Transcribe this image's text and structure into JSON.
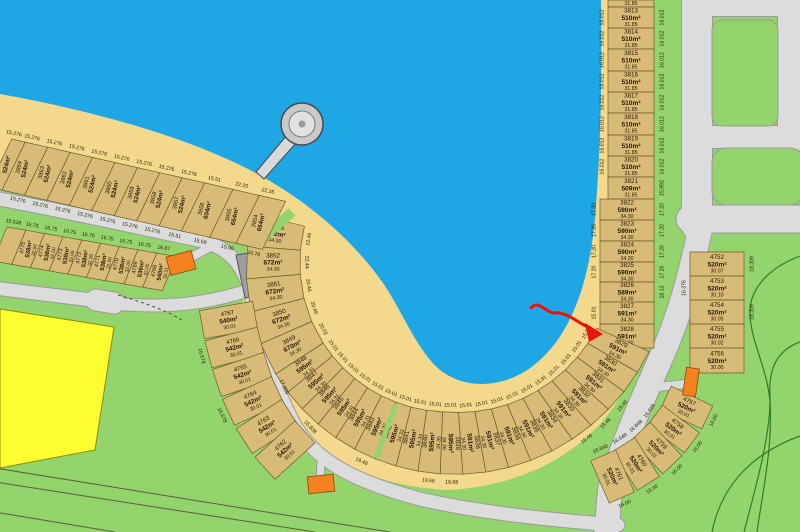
{
  "colors": {
    "water": "#1FA6E4",
    "beach": "#F4D98C",
    "grass": "#94D46C",
    "lot_fill": "#D8BB77",
    "lot_stroke": "#6E5B2B",
    "road_fill": "#DCDCDC",
    "road_stroke": "#9A9A9A",
    "reserve_gray": "#9E9E9E",
    "highlight_yellow": "#FDFD2F",
    "marker_orange": "#F5821F",
    "annotation_red": "#E8150A",
    "contour_green": "#2F7D24",
    "text": "#241A05"
  },
  "annotation": {
    "type": "hand-drawn-arrow",
    "points_to_lot": "3828"
  },
  "features": {
    "pier": "jetty-with-round-head",
    "orange_markers": 3,
    "yellow_parcel": true,
    "gray_reserve_parcel": true
  },
  "lot_groups": {
    "east_column": {
      "lots": [
        {
          "n": "",
          "a": "",
          "d": "31.85"
        },
        {
          "n": "3813",
          "a": "510m²",
          "d": "31.85",
          "in": "16.012",
          "out": "16.012"
        },
        {
          "n": "3814",
          "a": "510m²",
          "d": "31.85",
          "in": "16.012",
          "out": "16.012"
        },
        {
          "n": "3815",
          "a": "510m²",
          "d": "31.85",
          "in": "16.012",
          "out": "16.012"
        },
        {
          "n": "3816",
          "a": "510m²",
          "d": "31.85",
          "in": "16.012",
          "out": "16.012"
        },
        {
          "n": "3817",
          "a": "510m²",
          "d": "31.85",
          "in": "16.012",
          "out": "16.012"
        },
        {
          "n": "3818",
          "a": "510m²",
          "d": "31.85",
          "in": "16.012",
          "out": "16.012"
        },
        {
          "n": "3819",
          "a": "510m²",
          "d": "31.85",
          "in": "16.012",
          "out": "16.012"
        },
        {
          "n": "3820",
          "a": "510m²",
          "d": "31.85",
          "in": "16.012",
          "out": "16.012"
        },
        {
          "n": "3821",
          "a": "509m²",
          "d": "31.85",
          "out": "15.992"
        },
        {
          "n": "3822",
          "a": "590m²",
          "d": "34.30",
          "in": "17.20",
          "out": "17.20"
        },
        {
          "n": "3823",
          "a": "590m²",
          "d": "34.30",
          "in": "17.20",
          "out": "17.20"
        },
        {
          "n": "3824",
          "a": "590m²",
          "d": "34.30",
          "in": "17.20",
          "out": "17.20"
        },
        {
          "n": "3825",
          "a": "590m²",
          "d": "34.30",
          "in": "17.20",
          "out": "17.20"
        },
        {
          "n": "3826",
          "a": "589m²",
          "d": "34.30",
          "out": "18.13"
        },
        {
          "n": "3827",
          "a": "591m²",
          "d": "34.30",
          "in": "15.01"
        },
        {
          "n": "3828",
          "a": "591m²",
          "d": "34.30",
          "in": "15.01"
        }
      ]
    },
    "lake_arc": {
      "lots": [
        {
          "n": "3829",
          "a": "591m²",
          "d": "34.30",
          "in": "15.01"
        },
        {
          "n": "3830",
          "a": "591m²",
          "d": "34.30",
          "in": "15.01"
        },
        {
          "n": "3831",
          "a": "591m²",
          "d": "34.30",
          "in": "15.01",
          "out": "19.45"
        },
        {
          "n": "3832",
          "a": "591m²",
          "d": "34.30",
          "in": "15.01",
          "out": "19.46"
        },
        {
          "n": "3833",
          "a": "591m²",
          "d": "34.30",
          "in": "15.01",
          "out": "19.48"
        },
        {
          "n": "3834",
          "a": "591m²",
          "d": "34.30",
          "in": "15.01"
        },
        {
          "n": "3835",
          "a": "591m²",
          "d": "34.30",
          "in": "15.01"
        },
        {
          "n": "3836",
          "a": "591m²",
          "d": "34.30",
          "in": "15.01"
        },
        {
          "n": "3837",
          "a": "591m²",
          "d": "34.30",
          "in": "15.01"
        },
        {
          "n": "3838",
          "a": "591m²",
          "d": "34.30",
          "in": "15.01"
        },
        {
          "n": "3839",
          "a": "595m²",
          "d": "34.36",
          "in": "15.01",
          "out": "19.68"
        },
        {
          "n": "3840",
          "a": "595m²",
          "d": "34.35",
          "in": "15.01",
          "out": "19.66"
        },
        {
          "n": "3841",
          "a": "595m²",
          "d": "34.34",
          "in": "15.01"
        },
        {
          "n": "3842",
          "a": "595m²",
          "d": "34.33",
          "in": "15.01"
        },
        {
          "n": "3843",
          "a": "595m²",
          "d": "34.32",
          "in": "15.01",
          "out": "19.48"
        },
        {
          "n": "3844",
          "a": "595m²",
          "d": "34.31",
          "in": "15.01"
        },
        {
          "n": "3845",
          "a": "595m²",
          "d": "34.31",
          "in": "15.01"
        },
        {
          "n": "3846",
          "a": "595m²",
          "d": "34.31",
          "in": "15.01"
        },
        {
          "n": "3847",
          "a": "595m²",
          "d": "34.30",
          "in": "15.01"
        },
        {
          "n": "3848",
          "a": "595m²",
          "d": "34.31",
          "in": "15.01"
        },
        {
          "n": "3849",
          "a": "670m²",
          "d": "34.30",
          "in": "20.02"
        },
        {
          "n": "3850",
          "a": "672m²",
          "d": "34.30",
          "in": "20.46"
        },
        {
          "n": "3851",
          "a": "672m²",
          "d": "34.30",
          "in": "20.46"
        },
        {
          "n": "3852",
          "a": "672m²",
          "d": "34.30",
          "in": "22.44"
        },
        {
          "n": "3853",
          "a": "672m²",
          "d": "34.30",
          "in": "22.46"
        }
      ]
    },
    "northwest_row": {
      "lots": [
        {
          "n": "",
          "a": "524m²",
          "d": "",
          "in": "15.276"
        },
        {
          "n": "3864",
          "a": "524m²",
          "d": "",
          "in": "15.276",
          "out": "15.276"
        },
        {
          "n": "3863",
          "a": "524m²",
          "d": "",
          "in": "15.276",
          "out": "15.276"
        },
        {
          "n": "3862",
          "a": "524m²",
          "d": "",
          "in": "15.276",
          "out": "15.276"
        },
        {
          "n": "3861",
          "a": "524m²",
          "d": "",
          "in": "15.276",
          "out": "15.276"
        },
        {
          "n": "3860",
          "a": "524m²",
          "d": "",
          "in": "15.276",
          "out": "15.276"
        },
        {
          "n": "3859",
          "a": "524m²",
          "d": "",
          "in": "15.276",
          "out": "15.276"
        },
        {
          "n": "3858",
          "a": "524m²",
          "d": "",
          "in": "15.276",
          "out": "15.276"
        },
        {
          "n": "3857",
          "a": "524m²",
          "d": "",
          "in": "15.276",
          "out": "15.51"
        },
        {
          "n": "3856",
          "a": "604m²",
          "d": "",
          "in": "15.51",
          "out": "15.69"
        },
        {
          "n": "3855",
          "a": "654m²",
          "d": "",
          "in": "22.25",
          "out": "15.96"
        },
        {
          "n": "3854",
          "a": "654m²",
          "d": "",
          "in": "22.35",
          "out": "16.78"
        }
      ]
    },
    "west_row": {
      "lots": [
        {
          "n": "",
          "a": "",
          "d": "",
          "in": "15.538"
        },
        {
          "n": "4775",
          "a": "538m²",
          "d": "32.00",
          "in": "16.75"
        },
        {
          "n": "4774",
          "a": "538m²",
          "d": "32.00",
          "in": "16.75"
        },
        {
          "n": "4773",
          "a": "538m²",
          "d": "32.00",
          "in": "16.75"
        },
        {
          "n": "4772",
          "a": "538m²",
          "d": "32.00",
          "in": "16.75"
        },
        {
          "n": "4771",
          "a": "538m²",
          "d": "32.00",
          "in": "16.75"
        },
        {
          "n": "4770",
          "a": "538m²",
          "d": "32.00",
          "in": "16.75"
        },
        {
          "n": "4769",
          "a": "536m²",
          "d": "32.00",
          "in": "16.75"
        },
        {
          "n": "4768",
          "a": "540m²",
          "d": "32.01",
          "in": "16.87"
        }
      ]
    },
    "west_arc": {
      "lots": [
        {
          "n": "4767",
          "a": "540m²",
          "d": "30.01"
        },
        {
          "n": "4766",
          "a": "542m²",
          "d": "30.01",
          "out": "16.678"
        },
        {
          "n": "4765",
          "a": "542m²",
          "d": "30.01"
        },
        {
          "n": "4764",
          "a": "542m²",
          "d": "30.01",
          "in": "17.039",
          "out": "16.678"
        },
        {
          "n": "4763",
          "a": "542m²",
          "d": "30.01"
        },
        {
          "n": "4762",
          "a": "542m²",
          "d": "30.01",
          "in": "15.838"
        }
      ]
    },
    "south_arc": {
      "lots": [
        {
          "n": "4757",
          "a": "520m²",
          "d": "30.01",
          "in": "16.00"
        },
        {
          "n": "4758",
          "a": "520m²",
          "d": "30.01",
          "in": "16.00",
          "out": "16.648"
        },
        {
          "n": "4759",
          "a": "520m²",
          "d": "30.01",
          "in": "16.00",
          "out": "16.648"
        },
        {
          "n": "4760",
          "a": "520m²",
          "d": "30.01",
          "in": "16.00",
          "out": "16.648"
        },
        {
          "n": "4761",
          "a": "520m²",
          "d": "30.01",
          "in": "16.00",
          "out": "16.648"
        }
      ]
    },
    "south_column": {
      "lots": [
        {
          "n": "4752",
          "a": "520m²",
          "d": "30.07",
          "out": "18.209"
        },
        {
          "n": "4753",
          "a": "520m²",
          "d": "30.10",
          "in": "16.376"
        },
        {
          "n": "4754",
          "a": "520m²",
          "d": "30.05",
          "out": "18.209"
        },
        {
          "n": "4755",
          "a": "520m²",
          "d": "30.02"
        },
        {
          "n": "4756",
          "a": "520m²",
          "d": "30.00"
        }
      ]
    }
  }
}
